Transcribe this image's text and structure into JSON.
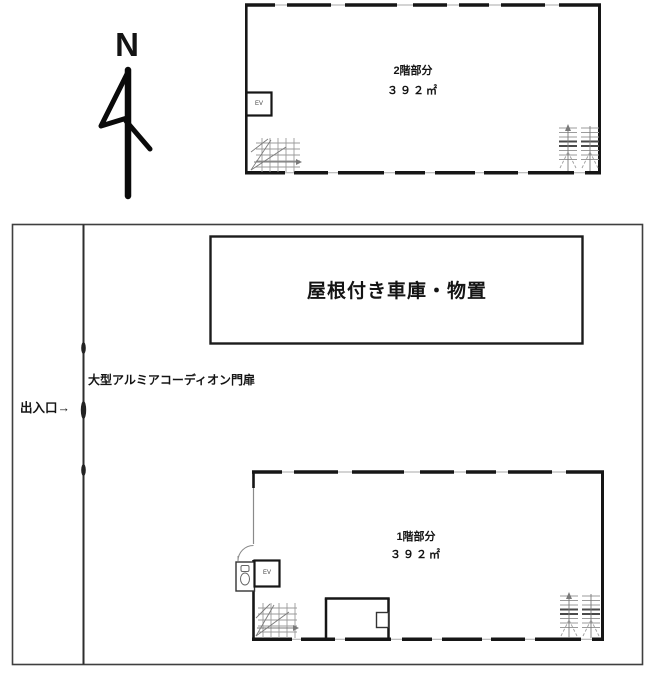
{
  "compass": {
    "label": "N"
  },
  "upper_floor": {
    "title": "2階部分",
    "area": "３９２㎡",
    "elevator": "EV"
  },
  "site": {
    "garage": "屋根付き車庫・物置",
    "gate": "大型アルミアコーディオン門扉",
    "entrance": "出入口→"
  },
  "lower_floor": {
    "title": "1階部分",
    "area": "３９２㎡",
    "elevator": "EV"
  },
  "colors": {
    "wall": "#161616",
    "site_border": "#3f3f3f",
    "stair_light": "#9b9b9b",
    "stair_dark": "#4a4a4a",
    "thin_line": "#aaaaaa"
  }
}
